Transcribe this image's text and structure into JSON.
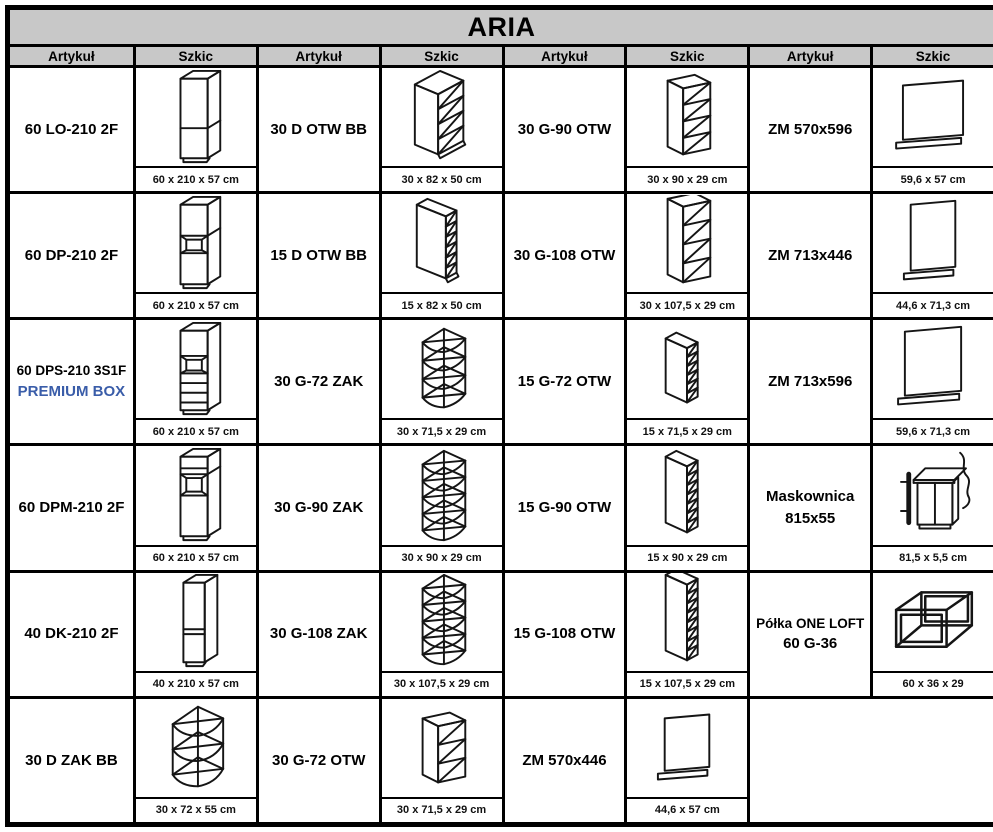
{
  "title": "ARIA",
  "column_headers": [
    "Artykuł",
    "Szkic",
    "Artykuł",
    "Szkic",
    "Artykuł",
    "Szkic",
    "Artykuł",
    "Szkic"
  ],
  "colors": {
    "header_bg": "#c8c8c8",
    "border": "#000000",
    "premium_blue": "#3a5da9",
    "sketch_stroke": "#151515"
  },
  "rows": [
    [
      {
        "article": "60 LO-210 2F",
        "sketch_icon": "tall-cabinet-2f",
        "dims": "60 x 210 x 57 cm"
      },
      {
        "article": "30 D OTW BB",
        "sketch_icon": "base-open-shelves",
        "dims": "30 x 82 x 50 cm"
      },
      {
        "article": "30 G-90 OTW",
        "sketch_icon": "wall-open-4",
        "dims": "30 x 90 x 29 cm"
      },
      {
        "article": "ZM 570x596",
        "sketch_icon": "end-panel-wide",
        "dims": "59,6 x 57 cm"
      }
    ],
    [
      {
        "article": "60 DP-210 2F",
        "sketch_icon": "tall-cabinet-oven",
        "dims": "60 x 210 x 57 cm"
      },
      {
        "article": "15 D OTW BB",
        "sketch_icon": "base-open-narrow",
        "dims": "15 x 82 x 50 cm"
      },
      {
        "article": "30 G-108 OTW",
        "sketch_icon": "wall-open-4-tall",
        "dims": "30 x 107,5 x 29 cm"
      },
      {
        "article": "ZM 713x446",
        "sketch_icon": "end-panel-tall-narrow",
        "dims": "44,6 x 71,3 cm"
      }
    ],
    [
      {
        "article": "60 DPS-210 3S1F",
        "article_line2": "PREMIUM BOX",
        "line2_style": "premium",
        "sketch_icon": "tall-cabinet-oven-drawers",
        "dims": "60 x 210 x 57 cm"
      },
      {
        "article": "30 G-72 ZAK",
        "sketch_icon": "corner-shelf-4",
        "dims": "30 x 71,5 x 29 cm"
      },
      {
        "article": "15 G-72 OTW",
        "sketch_icon": "wall-open-narrow-6",
        "dims": "15 x 71,5 x 29 cm"
      },
      {
        "article": "ZM 713x596",
        "sketch_icon": "end-panel-tall-wide",
        "dims": "59,6 x 71,3 cm"
      }
    ],
    [
      {
        "article": "60 DPM-210 2F",
        "sketch_icon": "tall-cabinet-microwave",
        "dims": "60 x 210 x 57 cm"
      },
      {
        "article": "30 G-90 ZAK",
        "sketch_icon": "corner-shelf-5",
        "dims": "30 x 90 x 29 cm"
      },
      {
        "article": "15 G-90 OTW",
        "sketch_icon": "wall-open-narrow-7",
        "dims": "15 x 90 x 29 cm"
      },
      {
        "article": "Maskownica",
        "article_line2": "815x55",
        "line2_style": "plain",
        "sketch_icon": "cover-strip",
        "dims": "81,5 x 5,5 cm"
      }
    ],
    [
      {
        "article": "40 DK-210 2F",
        "sketch_icon": "tall-cabinet-2f-narrow",
        "dims": "40 x 210 x 57 cm"
      },
      {
        "article": "30 G-108 ZAK",
        "sketch_icon": "corner-shelf-5-tall",
        "dims": "30 x 107,5 x 29 cm"
      },
      {
        "article": "15 G-108 OTW",
        "sketch_icon": "wall-open-narrow-8",
        "dims": "15 x 107,5 x 29 cm"
      },
      {
        "article": "Półka ONE LOFT",
        "article_line2": "60 G-36",
        "line2_style": "plain",
        "sketch_icon": "frame-shelf",
        "dims": "60 x 36 x 29"
      }
    ],
    [
      {
        "article": "30 D ZAK BB",
        "sketch_icon": "corner-base-shelf",
        "dims": "30 x 72 x 55 cm"
      },
      {
        "article": "30 G-72 OTW",
        "sketch_icon": "wall-open-3",
        "dims": "30 x 71,5 x 29 cm"
      },
      {
        "article": "ZM 570x446",
        "sketch_icon": "end-panel-small",
        "dims": "44,6 x 57 cm"
      },
      {
        "empty": true
      }
    ]
  ]
}
